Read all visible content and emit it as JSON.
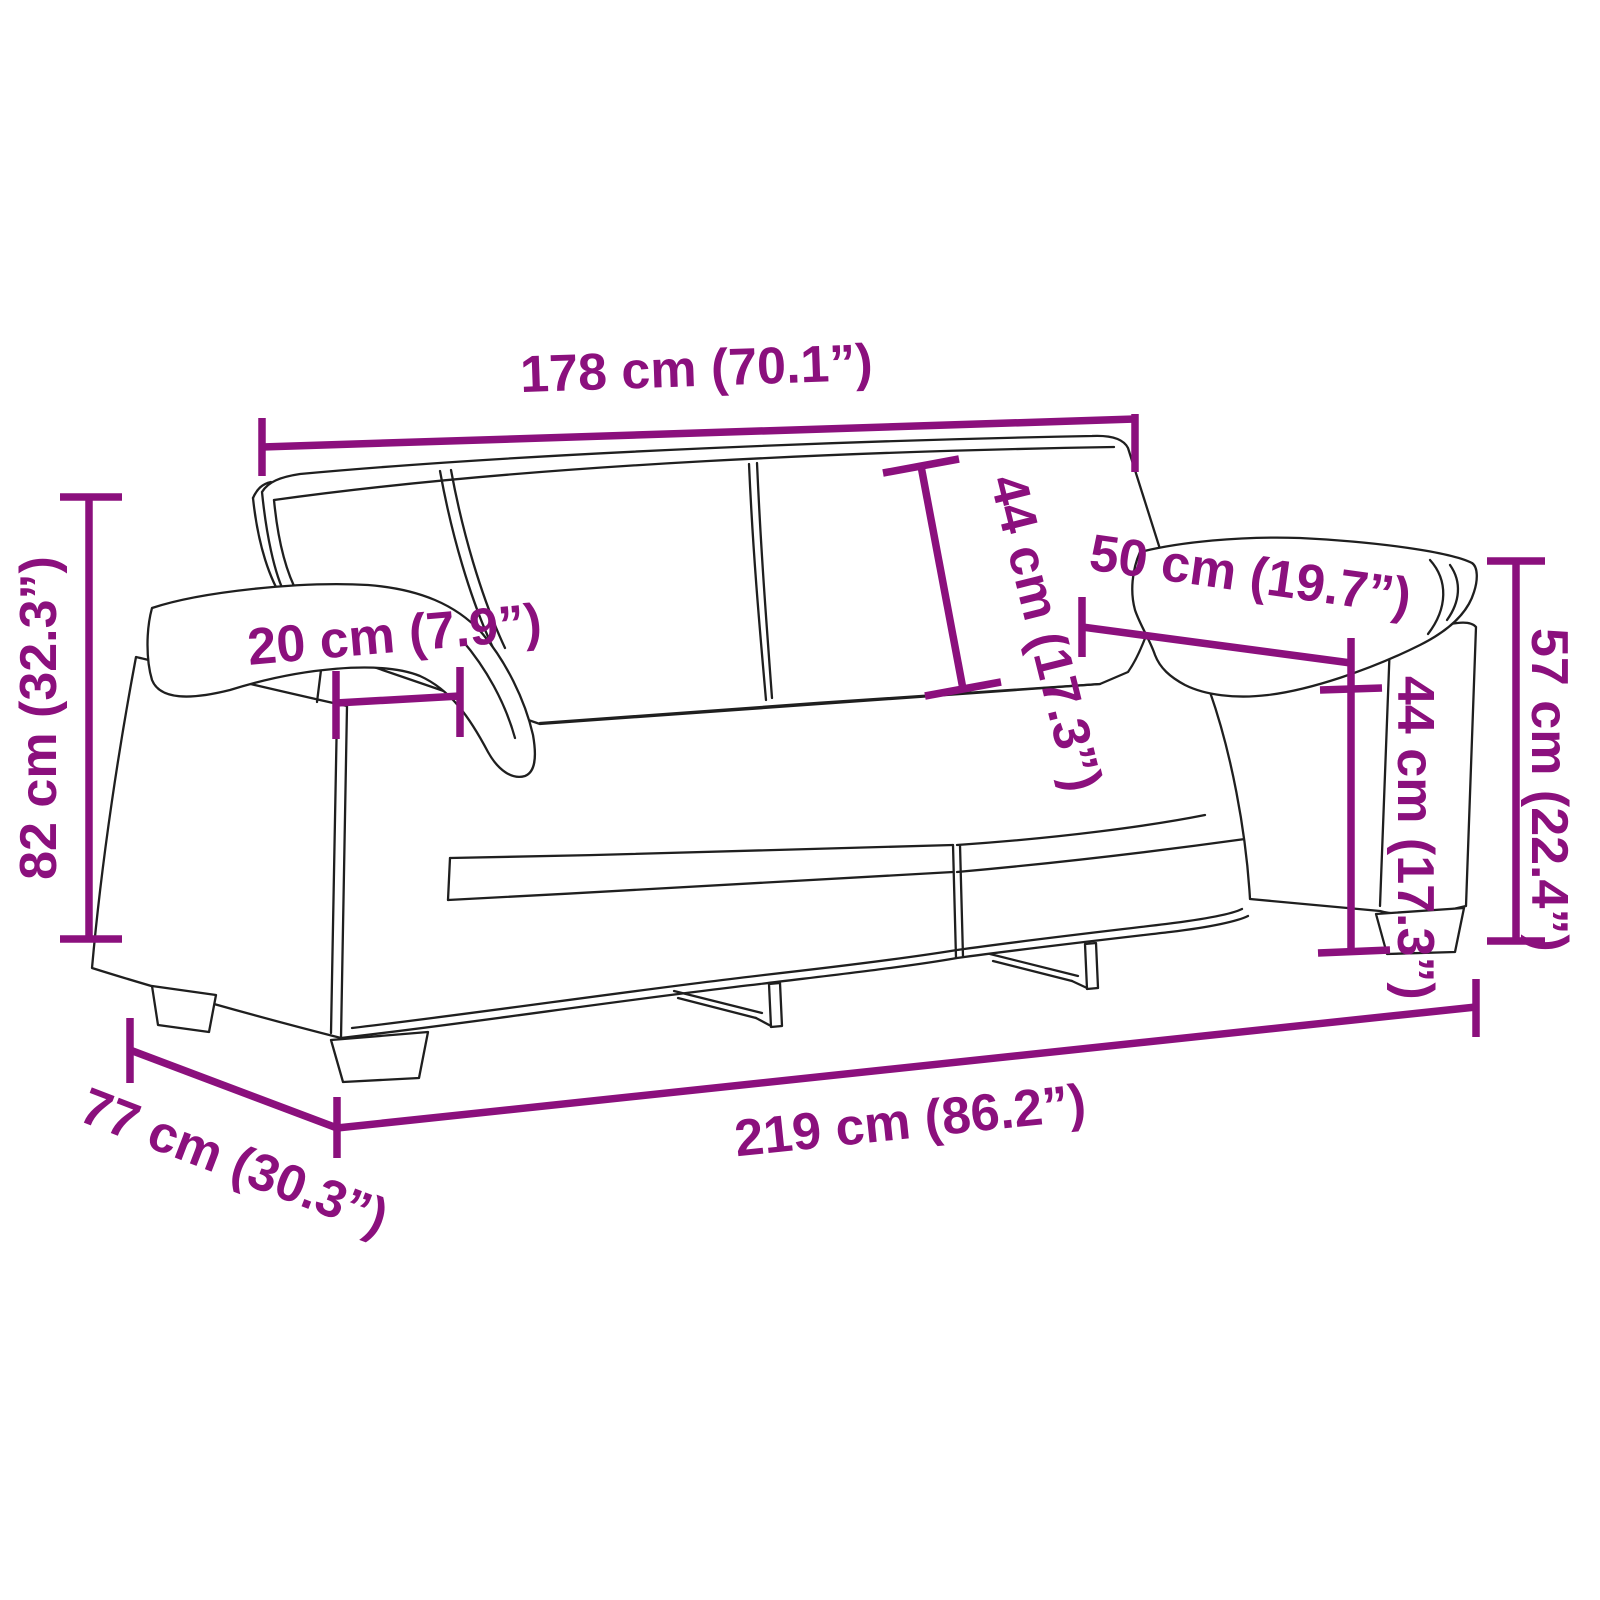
{
  "diagram": {
    "subject": "2-seater sofa dimension drawing",
    "unit_primary": "cm",
    "unit_secondary": "inch",
    "colors": {
      "dimension": "#8B107D",
      "outline": "#1F1F1F",
      "background": "#FFFFFF"
    },
    "dimensions": [
      {
        "name": "backrest-width",
        "value_cm": 178,
        "value_in": 70.1,
        "label": "178 cm (70.1”)"
      },
      {
        "name": "back-cushion-height",
        "value_cm": 44,
        "value_in": 17.3,
        "label": "44 cm (17.3”)"
      },
      {
        "name": "armrest-length",
        "value_cm": 50,
        "value_in": 19.7,
        "label": "50 cm (19.7”)"
      },
      {
        "name": "seat-height",
        "value_cm": 44,
        "value_in": 17.3,
        "label": "44 cm (17.3”)"
      },
      {
        "name": "armrest-height",
        "value_cm": 57,
        "value_in": 22.4,
        "label": "57 cm (22.4”)"
      },
      {
        "name": "armrest-width",
        "value_cm": 20,
        "value_in": 7.9,
        "label": "20 cm (7.9”)"
      },
      {
        "name": "total-height",
        "value_cm": 82,
        "value_in": 32.3,
        "label": "82 cm (32.3”)"
      },
      {
        "name": "depth",
        "value_cm": 77,
        "value_in": 30.3,
        "label": "77 cm (30.3”)"
      },
      {
        "name": "total-width",
        "value_cm": 219,
        "value_in": 86.2,
        "label": "219 cm (86.2”)"
      }
    ]
  }
}
